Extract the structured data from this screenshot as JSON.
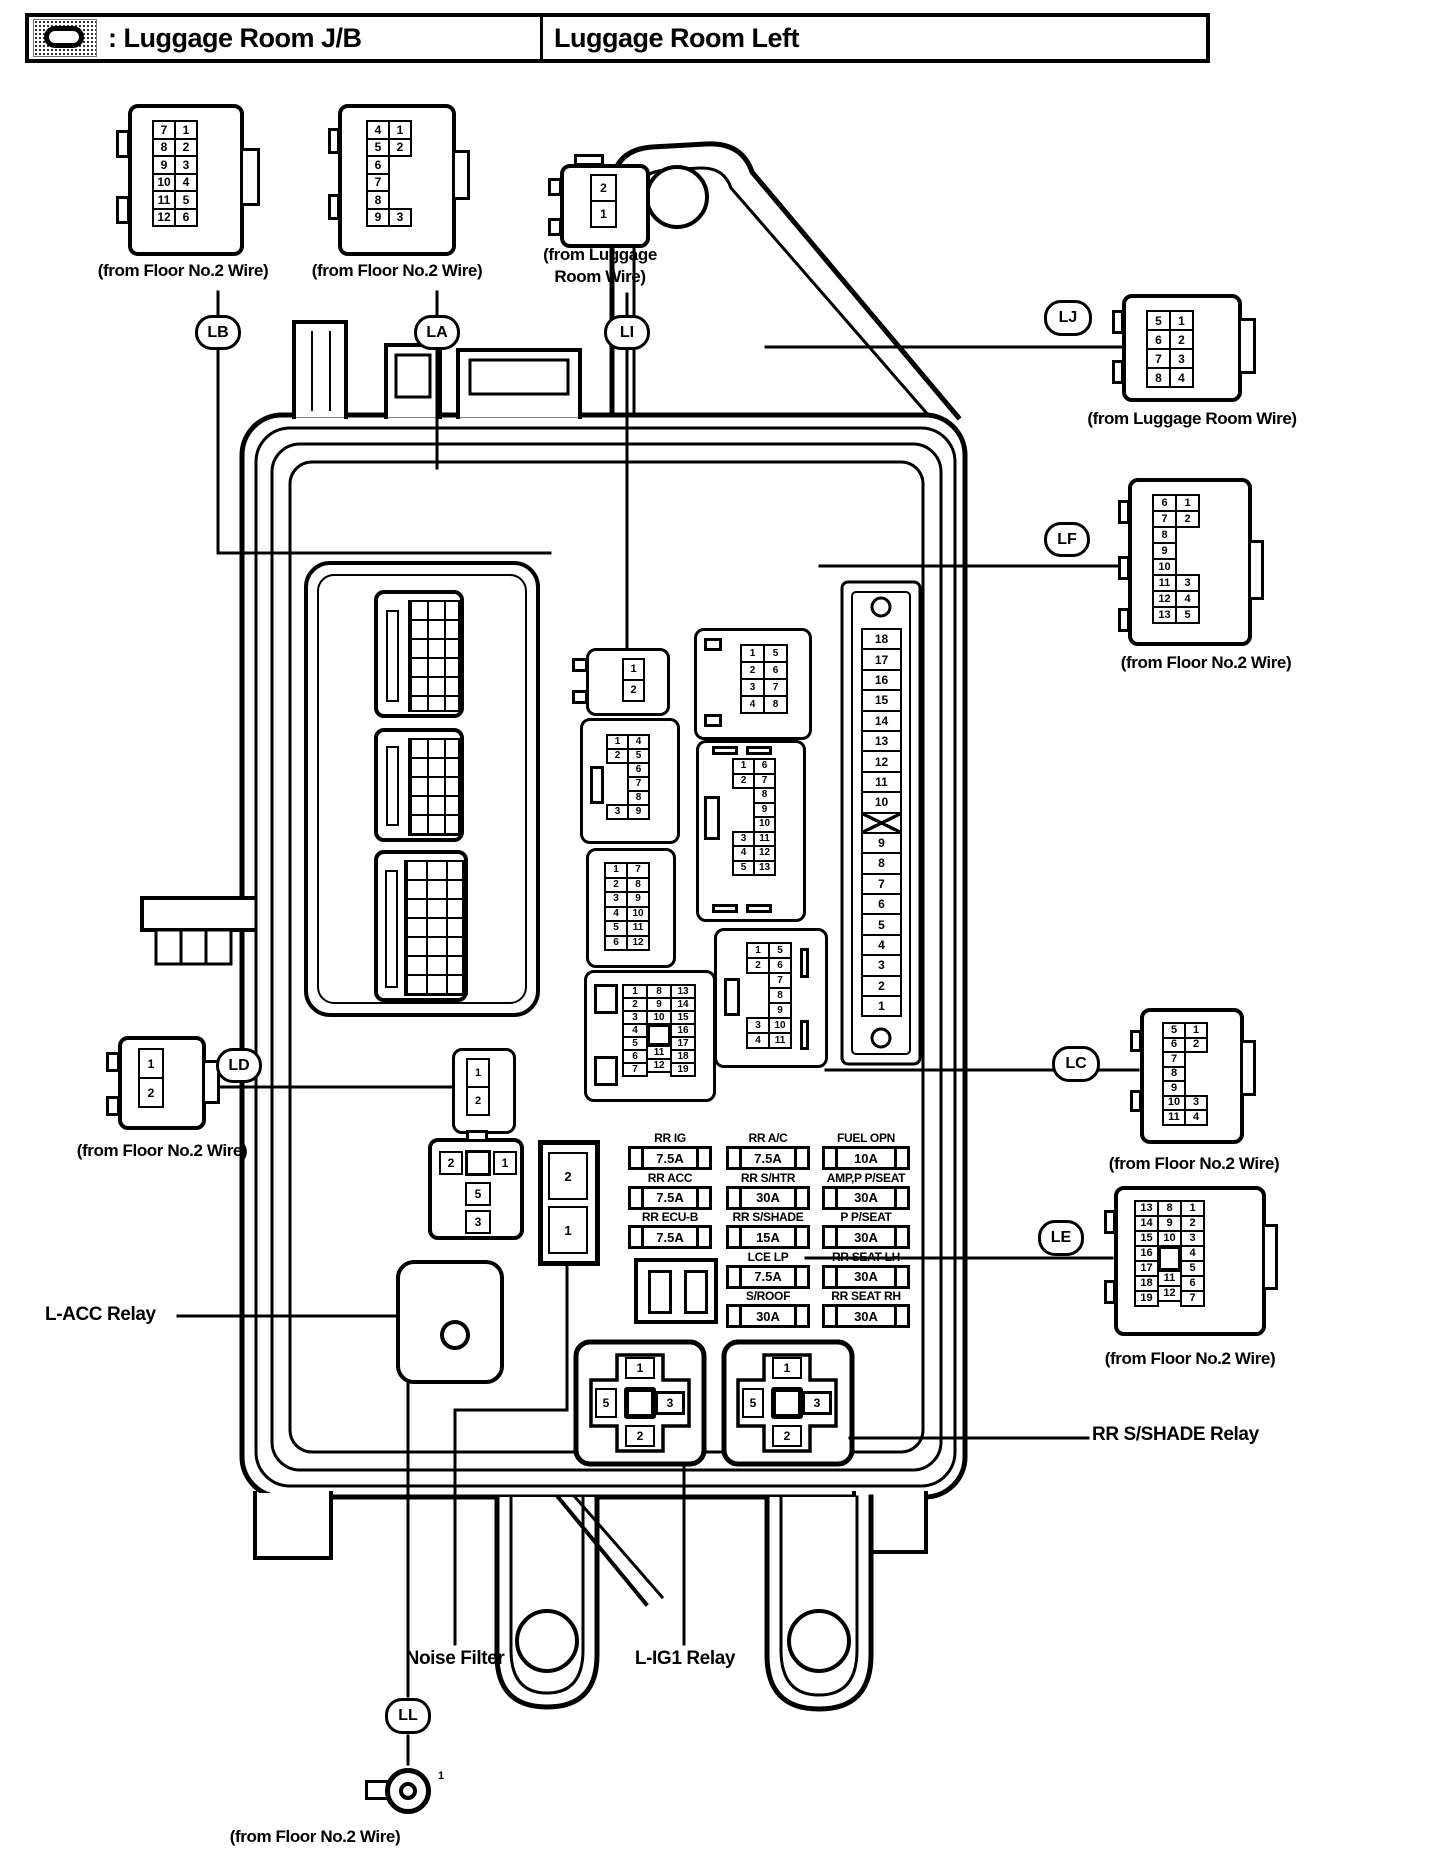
{
  "header": {
    "symbol_icon": "junction-block-symbol",
    "symbol_label": ": Luggage Room J/B",
    "title": "Luggage Room Left"
  },
  "ovals": {
    "lb": "LB",
    "la": "LA",
    "li": "LI",
    "lj": "LJ",
    "lf": "LF",
    "lc": "LC",
    "ld": "LD",
    "le": "LE",
    "ll": "LL"
  },
  "captions": {
    "lb": "(from Floor No.2 Wire)",
    "la": "(from Floor No.2 Wire)",
    "li_line1": "(from Luggage",
    "li_line2": "Room Wire)",
    "lj": "(from Luggage Room Wire)",
    "lf": "(from Floor No.2 Wire)",
    "lc": "(from Floor No.2 Wire)",
    "ld": "(from Floor No.2 Wire)",
    "le": "(from Floor No.2 Wire)",
    "ll": "(from Floor No.2 Wire)"
  },
  "connectors": {
    "lb": [
      [
        "7",
        "8",
        "9",
        "10",
        "11",
        "12"
      ],
      [
        "1",
        "2",
        "3",
        "4",
        "5",
        "6"
      ]
    ],
    "la": [
      [
        "4",
        "5",
        "6",
        "7",
        "8",
        "9"
      ],
      [
        "1",
        "2",
        null,
        null,
        null,
        "3"
      ]
    ],
    "li": [
      [
        "2",
        "1"
      ]
    ],
    "lj": [
      [
        "5",
        "6",
        "7",
        "8"
      ],
      [
        "1",
        "2",
        "3",
        "4"
      ]
    ],
    "lf": [
      [
        "6",
        "7",
        "8",
        "9",
        "10",
        "11",
        "12",
        "13"
      ],
      [
        "1",
        "2",
        null,
        null,
        null,
        "3",
        "4",
        "5"
      ]
    ],
    "lc": [
      [
        "5",
        "6",
        "7",
        "8",
        "9",
        "10",
        "11"
      ],
      [
        "1",
        "2",
        null,
        null,
        null,
        "3",
        "4"
      ]
    ],
    "ld": [
      [
        "1",
        "2"
      ]
    ],
    "le": [
      [
        "13",
        "14",
        "15",
        "16",
        "17",
        "18",
        "19"
      ],
      [
        "8",
        "9",
        "10",
        "SQ",
        "11",
        "12"
      ],
      [
        "1",
        "2",
        "3",
        "4",
        "5",
        "6",
        "7"
      ]
    ],
    "ll_pin": "1"
  },
  "internal": {
    "c2": [
      [
        "1",
        "2"
      ]
    ],
    "c9": [
      [
        "1",
        "2",
        null,
        null,
        null,
        "3"
      ],
      [
        "4",
        "5",
        "6",
        "7",
        "8",
        "9"
      ]
    ],
    "c12": [
      [
        "1",
        "2",
        "3",
        "4",
        "5",
        "6"
      ],
      [
        "7",
        "8",
        "9",
        "10",
        "11",
        "12"
      ]
    ],
    "c19": [
      [
        "1",
        "2",
        "3",
        "4",
        "5",
        "6",
        "7"
      ],
      [
        "8",
        "9",
        "10",
        "SQ",
        "11",
        "12"
      ],
      [
        "13",
        "14",
        "15",
        "16",
        "17",
        "18",
        "19"
      ]
    ],
    "c8": [
      [
        "1",
        "2",
        "3",
        "4"
      ],
      [
        "5",
        "6",
        "7",
        "8"
      ]
    ],
    "c13": [
      [
        "1",
        "2",
        null,
        null,
        null,
        "3",
        "4",
        "5"
      ],
      [
        "6",
        "7",
        "8",
        "9",
        "10",
        "11",
        "12",
        "13"
      ]
    ],
    "c11": [
      [
        "1",
        "2",
        null,
        null,
        null,
        "3",
        "4"
      ],
      [
        "5",
        "6",
        "7",
        "8",
        "9",
        "10",
        "11"
      ]
    ],
    "ld2": [
      [
        "1",
        "2"
      ]
    ]
  },
  "fuse_strip": {
    "cells": [
      [
        "18",
        "17",
        "16",
        "15",
        "14",
        "13",
        "12",
        "11",
        "10",
        "X",
        "9",
        "8",
        "7",
        "6",
        "5",
        "4",
        "3",
        "2",
        "1"
      ]
    ]
  },
  "fuses": {
    "col1": [
      {
        "name": "RR IG",
        "amp": "7.5A"
      },
      {
        "name": "RR ACC",
        "amp": "7.5A"
      },
      {
        "name": "RR ECU-B",
        "amp": "7.5A"
      }
    ],
    "col2": [
      {
        "name": "RR A/C",
        "amp": "7.5A"
      },
      {
        "name": "RR S/HTR",
        "amp": "30A"
      },
      {
        "name": "RR S/SHADE",
        "amp": "15A"
      },
      {
        "name": "LCE LP",
        "amp": "7.5A"
      },
      {
        "name": "S/ROOF",
        "amp": "30A"
      }
    ],
    "col3": [
      {
        "name": "FUEL OPN",
        "amp": "10A"
      },
      {
        "name": "AMP,P P/SEAT",
        "amp": "30A"
      },
      {
        "name": "P P/SEAT",
        "amp": "30A"
      },
      {
        "name": "RR SEAT LH",
        "amp": "30A"
      },
      {
        "name": "RR SEAT RH",
        "amp": "30A"
      }
    ]
  },
  "relay_pins": {
    "top": "1",
    "left": "5",
    "right": "3",
    "bottom": "2"
  },
  "lacc_socket": {
    "left": "2",
    "right": "1",
    "mid": "5",
    "bottom": "3"
  },
  "noise_pins": {
    "top": "2",
    "bottom": "1"
  },
  "labels": {
    "lacc": "L-ACC Relay",
    "noise": "Noise Filter",
    "lig1": "L-IG1 Relay",
    "rrsshade": "RR S/SHADE Relay"
  }
}
